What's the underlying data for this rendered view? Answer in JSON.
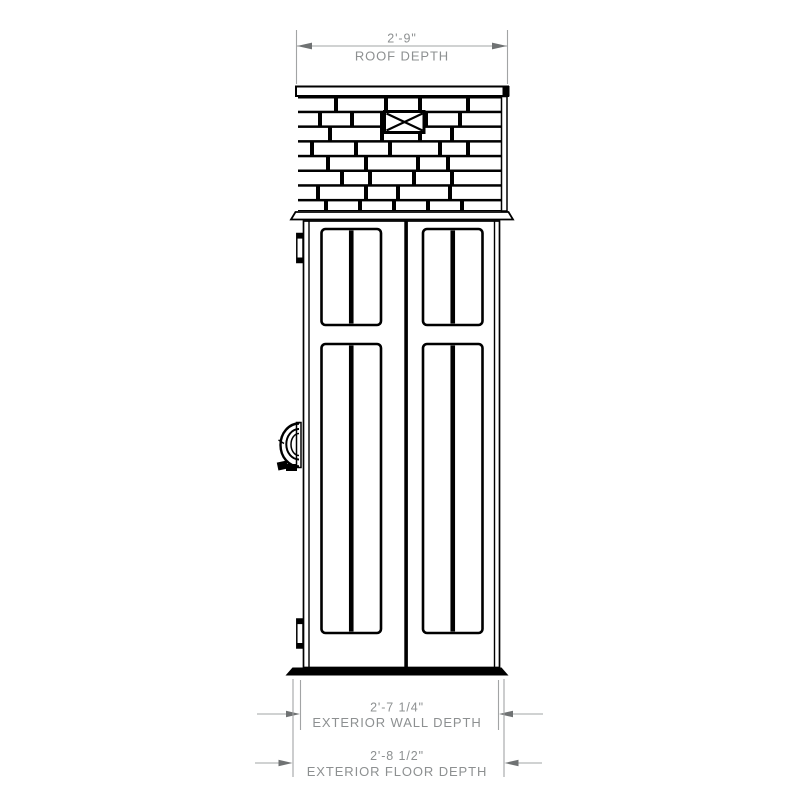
{
  "drawing": {
    "title": "shed-side-elevation",
    "dimensions": {
      "roof": {
        "value": "2'-9\"",
        "label": "ROOF DEPTH"
      },
      "wall": {
        "value": "2'-7 1/4\"",
        "label": "EXTERIOR WALL DEPTH"
      },
      "floor": {
        "value": "2'-8 1/2\"",
        "label": "EXTERIOR FLOOR DEPTH"
      }
    },
    "colors": {
      "background": "#ffffff",
      "line": "#000000",
      "dim_line": "#a2a4a5",
      "dim_arrow": "#6f7273",
      "dim_text": "#8d9091"
    }
  }
}
